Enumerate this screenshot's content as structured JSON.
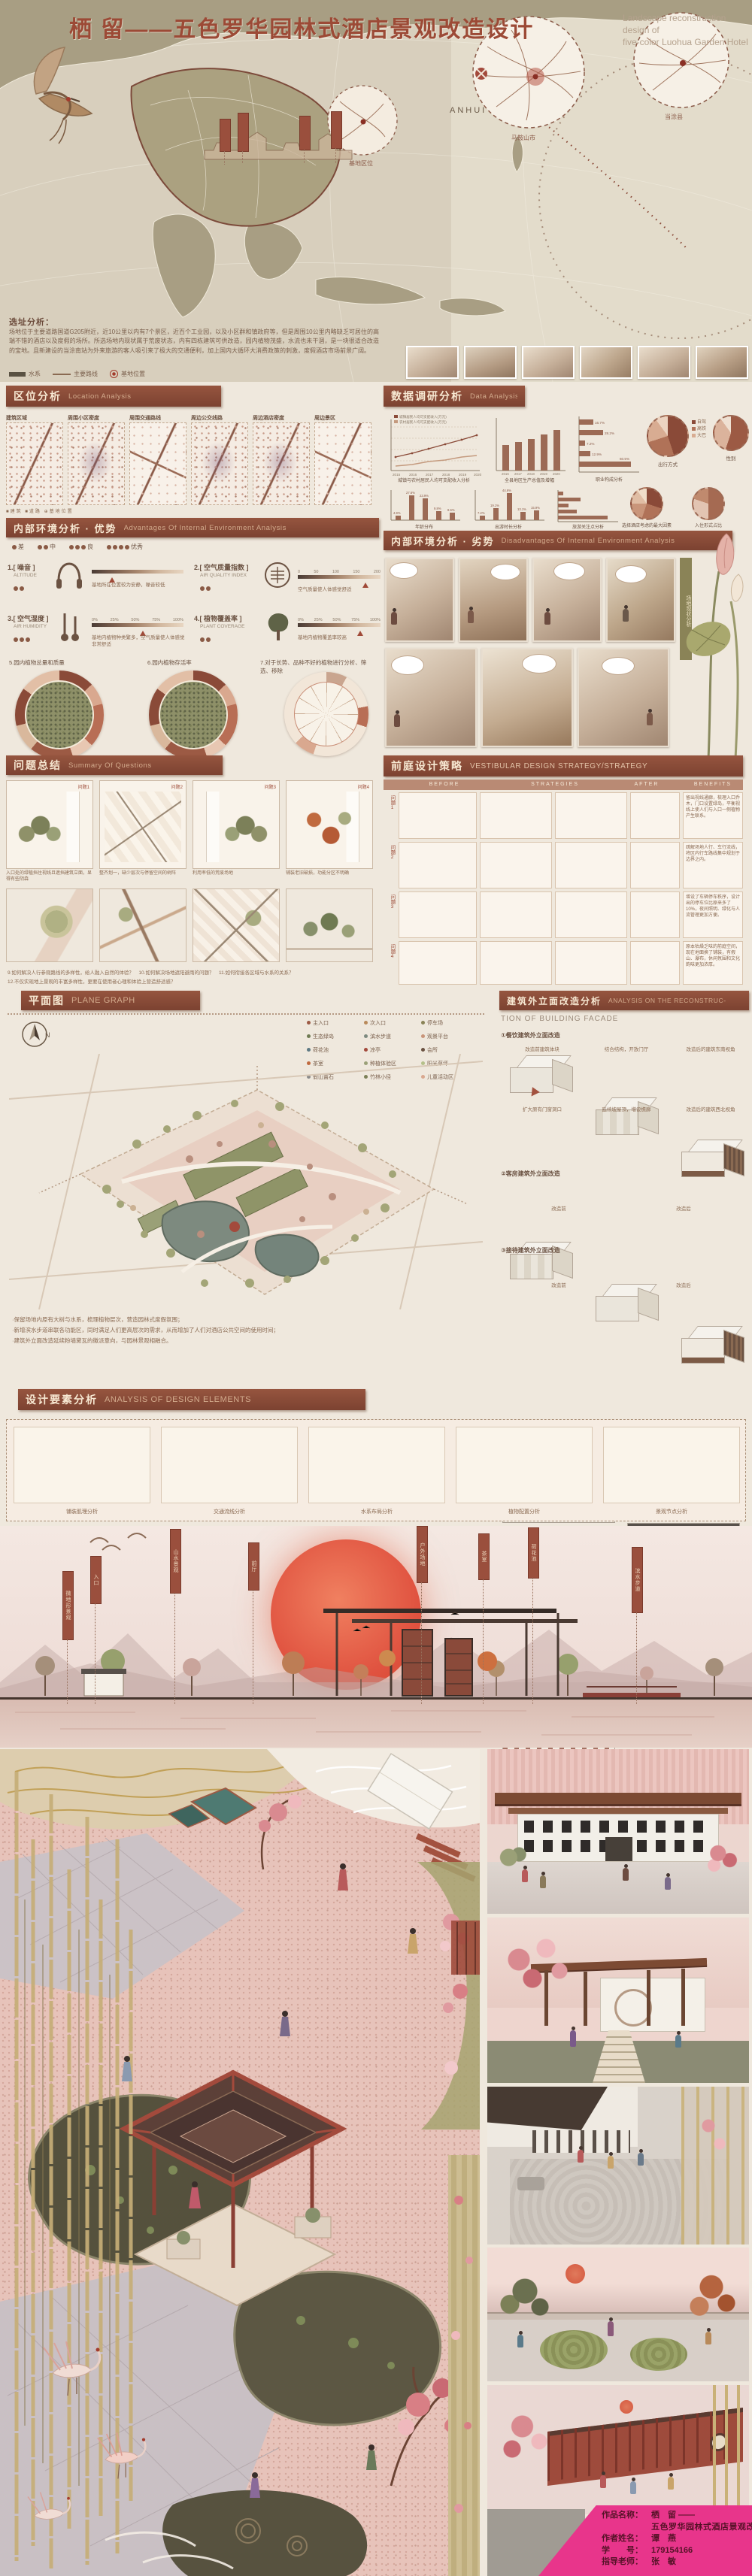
{
  "title": {
    "zh": "栖 留——五色罗华园林式酒店景观改造设计",
    "en1": "Landscape reconstruction design of",
    "en2": "five-color Luohua Garden Hotel"
  },
  "map": {
    "anhui": "ANHUI",
    "circle1": "马鞍山市",
    "circle2": "当涂县",
    "circle3": "基地区位",
    "site_title": "选址分析：",
    "site_text": "场地位于主要道路国道G205附近，近10公里以内有7个景区，近百个工业园，以及小区群和镇政府等，但是周围10公里内略缺乏可居住的高端不错的酒店以及度假的场所。所选场地内现状属于荒废状态，内有四栋建筑可供改造，园内植物茂盛，水流也未干涸，是一块很适合改造的宝地。且新建设的当涂南站为外来旅游的客人吸引来了极大的交通便利，加上国内大循环大消费政策的刺激，度假酒店市场前景广阔。",
    "legend_water": "水系",
    "legend_route": "主要路线",
    "legend_site": "基地位置"
  },
  "sec_location": {
    "zh": "区位分析",
    "en": "Location Analysis",
    "maps": [
      "建筑区域",
      "周围小区密度",
      "周围交通路线",
      "周边公交线路",
      "周边酒店密度",
      "周边景区"
    ],
    "mini_legend": "■建筑 ■道路 ⊕基地位置"
  },
  "sec_data": {
    "zh": "数据调研分析",
    "en": "Data Analysis"
  },
  "sec_adv": {
    "zh": "内部环境分析 · 优势",
    "en": "Advantages Of Internal Environment Analysis",
    "rating": [
      "差",
      "中",
      "良",
      "优秀"
    ],
    "items": [
      {
        "no": "1.",
        "zh": "[ 噪音 ]",
        "en": "ALTITUDE",
        "note": "基地所在位置较为安静，噪音较低"
      },
      {
        "no": "2.",
        "zh": "[ 空气质量指数 ]",
        "en": "AIR QUALITY INDEX",
        "note": "空气质量使人体感觉舒适",
        "t0": "0",
        "t1": "50",
        "t2": "100",
        "t3": "150",
        "t4": "200"
      },
      {
        "no": "3.",
        "zh": "[ 空气湿度 ]",
        "en": "AIR HUMIDITY",
        "note": "基地内植物种类繁多，空气质量使人体感觉非常舒适",
        "t0": "0%",
        "t1": "25%",
        "t2": "50%",
        "t3": "75%",
        "t4": "100%"
      },
      {
        "no": "4.",
        "zh": "[ 植物覆盖率 ]",
        "en": "PLANT COVERAGE",
        "note": "基地内植物覆盖率较高",
        "t0": "0%",
        "t1": "25%",
        "t2": "50%",
        "t3": "75%",
        "t4": "100%"
      }
    ],
    "circle_titles": [
      "5.园内植物总量和质量",
      "6.园内植物存活率",
      "7.对于长势、品种不好的植物进行分析、筛选、移除"
    ]
  },
  "sec_dis": {
    "zh": "内部环境分析 · 劣势",
    "en": "Disadvantages Of Internal Environment Analysis",
    "strip": "场地现状分析"
  },
  "sec_q": {
    "zh": "问题总结",
    "en": "Summary Of Questions",
    "tags": [
      "问题1",
      "问题2",
      "问题3",
      "问题4"
    ],
    "captions": [
      "入口处的绿植挡住视线且遮挡建筑立面，显得有些阴森",
      "整齐划一，缺少层次与停留空间的树阵",
      "利用率低的荒废场地",
      "铺装老旧破损，功能分区不明确"
    ],
    "q1": "9.如何解决人行参观路线的多样性，给人融入自然的体验？　10.如何解决场地遮阳避雨的问题？　11.如何衔接各区域与水系的关系？",
    "q2": "12.不仅实现地上景观的丰富多样性，更要在使用者心理和体验上营造舒适感？"
  },
  "sec_strategy": {
    "zh": "前庭设计策略",
    "en": "VESTIBULAR DESIGN STRATEGY/STRATEGY",
    "cols": [
      "BEFORE",
      "STRATEGIES",
      "AFTER",
      "BENEFITS"
    ],
    "rows": [
      {
        "tag": "问题1",
        "benefit": "留出视线通廊，梳理入口乔木，门口设置绿岛，平衡视线上使人们与入口一侧植物产生联系。"
      },
      {
        "tag": "问题2",
        "benefit": "疏解场地人行、车行流线，将区内行车路线集中规划于边界之内。"
      },
      {
        "tag": "问题3",
        "benefit": "增设了车辆停车秩序，设计出的停车位比原来多了10%，夜间照明、绿化与人流管理更加方便。"
      },
      {
        "tag": "问题4",
        "benefit": "原本枯燥乏味的前庭空间，现在地面换了铺装，有假山、瀑布，休闲氛围和文化韵味更加浓厚。"
      }
    ]
  },
  "sec_plan": {
    "zh": "平面图",
    "en": "PLANE GRAPH",
    "north": "N",
    "legend": [
      "主入口",
      "次入口",
      "停车场",
      "生态绿岛",
      "滨水步道",
      "观景平台",
      "荷花池",
      "凉亭",
      "会所",
      "茶室",
      "种植体验区",
      "阳光草坪",
      "假山置石",
      "竹林小径",
      "儿童活动区"
    ],
    "notes": [
      "·保留场地内原有大树与水系，梳理植物层次，营造园林式度假氛围；",
      "·新增滨水步道串联各功能区，同时满足人们更高层次的需求，从而增加了人们对酒店公共空间的使用时间；",
      "·建筑外立面改造延续粉墙黛瓦的徽派意向，与园林景观相融合。"
    ]
  },
  "sec_facade": {
    "zh": "建筑外立面改造分析",
    "en1": "ANALYSIS ON THE RECONSTRUC-",
    "en2": "TION OF BUILDING FACADE",
    "sub1": "①餐饮建筑外立面改造",
    "sub2": "②客房建筑外立面改造",
    "sub3": "③接待建筑外立面改造",
    "row1": [
      "改造前建筑体块",
      "结合结构，开放门厅",
      "改造后的建筑东南视角"
    ],
    "row2": [
      "扩大原有门窗洞口",
      "延续坡屋顶，增设檐廊",
      "改造后的建筑西北视角"
    ],
    "cap_before": "改造前",
    "cap_after": "改造后"
  },
  "sec_elements": {
    "zh": "设计要素分析",
    "en": "ANALYSIS OF DESIGN ELEMENTS",
    "captions": [
      "铺装肌理分析",
      "交通流线分析",
      "水系布局分析",
      "植物配置分析",
      "景观节点分析"
    ]
  },
  "panorama": {
    "banners": [
      "微地形景观",
      "入口",
      "山水景观",
      "前厅",
      "户外场地",
      "茶室",
      "荷花池",
      "滨水步道"
    ]
  },
  "credits": {
    "l1_label": "作品名称：",
    "l1_value": "栖　留 ——",
    "l2_value": "五色罗华园林式酒店景观改造设计",
    "l3_label": "作者姓名：",
    "l3_value": "谭　燕",
    "l4_label": "学　　号：",
    "l4_value": "179154166",
    "l5_label": "指导老师：",
    "l5_value": "张　敏"
  },
  "colors": {
    "header_bar": "#8c4f3f",
    "title_red": "#9c4a36",
    "sun": "#e0563e",
    "credit_pink": "#e8358b",
    "pond": "#56523e",
    "pavilion_red": "#a34a3c"
  },
  "chart_data": [
    {
      "type": "line",
      "title": "城镇与农村居民人均可支配收入分析",
      "x": [
        2015,
        2016,
        2017,
        2018,
        2019,
        2020
      ],
      "series": [
        {
          "name": "城镇居民人均可支配收入(万元)",
          "values": [
            2.7,
            3.0,
            3.3,
            3.6,
            3.9,
            4.2
          ]
        },
        {
          "name": "农村居民人均可支配收入(万元)",
          "values": [
            1.4,
            1.5,
            1.7,
            1.8,
            2.0,
            2.2
          ]
        }
      ],
      "ylim": [
        0,
        5
      ],
      "grid": true,
      "legend_position": "top"
    },
    {
      "type": "bar",
      "title": "全县地区生产总值及增幅",
      "categories": [
        "2016",
        "2017",
        "2018",
        "2019",
        "2020"
      ],
      "values": [
        365,
        398,
        432,
        476,
        520
      ],
      "ylabel": "亿元",
      "ylim": [
        0,
        600
      ]
    },
    {
      "type": "bar",
      "title": "年龄分布",
      "categories": [
        "18岁以下",
        "18-25岁",
        "26-35岁",
        "36-50岁",
        "50岁以上"
      ],
      "values": [
        4.9,
        27.6,
        23.9,
        9.8,
        8.6
      ],
      "labels": [
        "4.9%",
        "27.6%",
        "23.9%",
        "9.8%",
        "8.6%"
      ],
      "ylim": [
        0,
        30
      ]
    },
    {
      "type": "bar",
      "title": "出游时长分析",
      "categories": [
        "当天往返",
        "2天",
        "3-5天",
        "5-7天",
        "7天以上"
      ],
      "values": [
        7.2,
        19.1,
        44.6,
        13.1,
        15.9
      ],
      "labels": [
        "7.2%",
        "19.1%",
        "44.6%",
        "13.1%",
        "15.9%"
      ],
      "ylim": [
        0,
        50
      ]
    },
    {
      "type": "hbar",
      "title": "职业构成分析",
      "categories": [
        "学生",
        "企业职员",
        "公务员",
        "自由职业",
        "其他"
      ],
      "values": [
        16.7,
        28.2,
        7.2,
        12.9,
        60.5
      ],
      "labels": [
        "16.7%",
        "28.2%",
        "7.2%",
        "12.9%",
        "60.5%"
      ],
      "xlim": [
        0,
        70
      ]
    },
    {
      "type": "hbar",
      "title": "旅游关注点分析",
      "categories": [
        "价格",
        "交通",
        "环境",
        "服务",
        "特色体验"
      ],
      "values": [
        5.8,
        24.2,
        11.6,
        20.3,
        54.8
      ],
      "labels": [
        "5.8%",
        "24.2%",
        "11.6%",
        "20.3%",
        "54.8%"
      ],
      "xlim": [
        0,
        60
      ]
    },
    {
      "type": "pie",
      "title": "出行方式",
      "labels": [
        "自驾",
        "高铁",
        "大巴",
        "其他"
      ],
      "values": [
        45,
        25,
        20,
        10
      ]
    },
    {
      "type": "pie",
      "title": "性别",
      "labels": [
        "男",
        "女",
        "未注明"
      ],
      "values": [
        55,
        35,
        10
      ]
    },
    {
      "type": "pie",
      "title": "选择酒店考虑的最大因素",
      "labels": [
        "环境卫生",
        "价格",
        "服务",
        "位置",
        "其他"
      ],
      "values": [
        30,
        25,
        20,
        15,
        10
      ]
    },
    {
      "type": "pie",
      "title": "入住形式占比",
      "labels": [
        "家庭出游",
        "情侣出行",
        "朋友结伴"
      ],
      "values": [
        50,
        30,
        20
      ]
    }
  ]
}
